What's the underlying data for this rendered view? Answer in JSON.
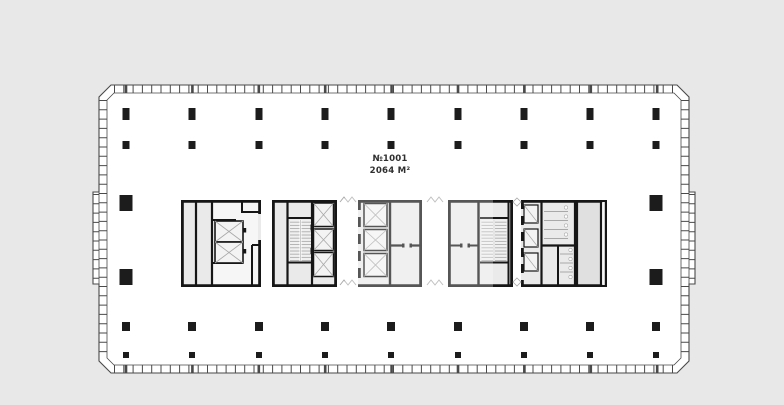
{
  "plan": {
    "unit_label": "№1001",
    "area_label": "2064 M²",
    "colors": {
      "bg": "#e8e8e8",
      "floor": "#ffffff",
      "wall": "#161616",
      "room": "#eaeaea",
      "room2": "#e0e0e0",
      "lobby": "#f6f6f6",
      "shaft": "#f3f3f3",
      "hatch": "#a8a8a8",
      "facade": "#4a4a4a",
      "column": "#1c1c1c",
      "text": "#2f2f2f",
      "watermark": "rgba(255,255,255,0.28)"
    },
    "columns": {
      "grid_x": [
        126,
        192,
        259,
        325,
        391,
        458,
        524,
        590,
        656
      ],
      "rows": [
        {
          "y": 108,
          "w": 7,
          "h": 12
        },
        {
          "y": 141,
          "w": 7,
          "h": 8
        },
        {
          "y": 322,
          "w": 8,
          "h": 9
        },
        {
          "y": 352,
          "w": 6,
          "h": 6
        }
      ],
      "core": {
        "w": 13,
        "h": 16,
        "positions": [
          {
            "x": 126,
            "y": 195
          },
          {
            "x": 656,
            "y": 195
          },
          {
            "x": 126,
            "y": 269
          },
          {
            "x": 656,
            "y": 269
          }
        ]
      }
    }
  }
}
